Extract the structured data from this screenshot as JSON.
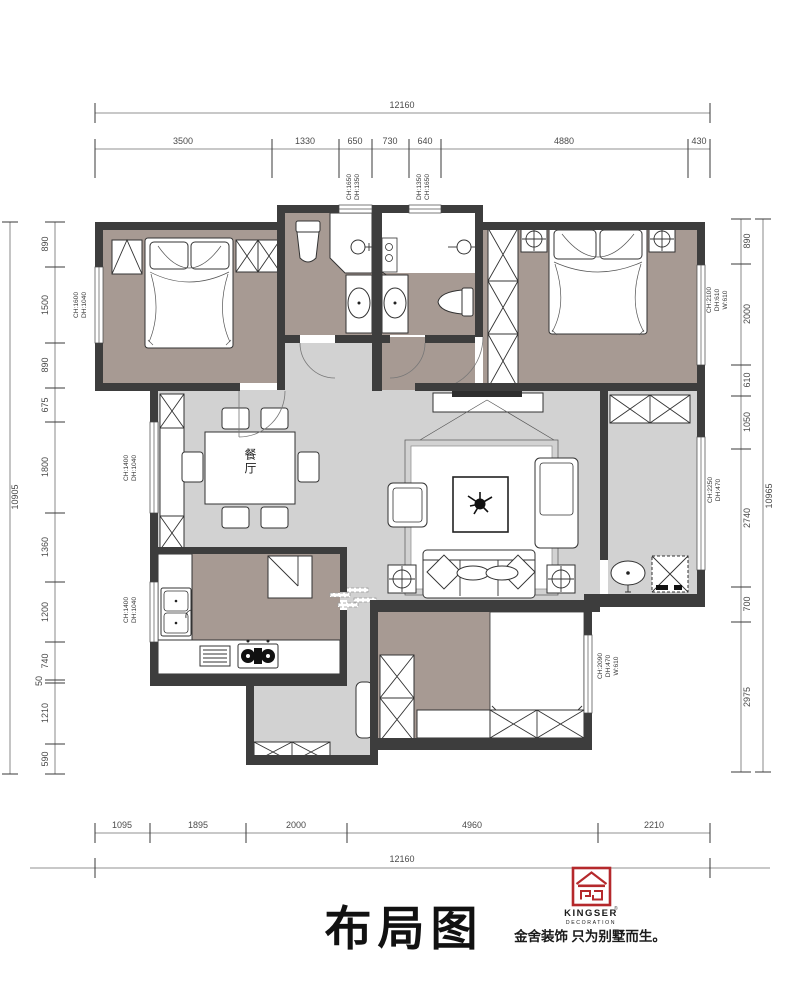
{
  "title": "布局图",
  "rooms": {
    "dining_label": "餐厅"
  },
  "logo": {
    "brand": "KINGSER",
    "registered": "®",
    "sub": "DECORATION",
    "tagline": "金舍装饰 只为别墅而生。",
    "accent_color": "#b5292c"
  },
  "dims": {
    "top": {
      "total": "12160",
      "segments": [
        "3500",
        "1330",
        "650",
        "730",
        "640",
        "4880",
        "430"
      ]
    },
    "bottom": {
      "total": "12160",
      "segments": [
        "1095",
        "1895",
        "2000",
        "4960",
        "2210"
      ]
    },
    "left": {
      "total": "10905",
      "segments": [
        "890",
        "1500",
        "890",
        "675",
        "1800",
        "1360",
        "1200",
        "740",
        "50",
        "1210",
        "590"
      ]
    },
    "right": {
      "total": "10965",
      "segments": [
        "890",
        "2000",
        "610",
        "1050",
        "2740",
        "700",
        "2975"
      ]
    }
  },
  "window_labels": {
    "top_a": {
      "l1": "CH:1650",
      "l2": "DH:1350"
    },
    "top_b": {
      "l1": "CH:1650",
      "l2": "DH:1350"
    },
    "left_a": {
      "l1": "CH:1600",
      "l2": "DH:1040"
    },
    "left_b": {
      "l1": "CH:1400",
      "l2": "DH:1040"
    },
    "left_c": {
      "l1": "CH:1400",
      "l2": "DH:1040"
    },
    "right_a": {
      "l1": "CH:2100",
      "l2": "DH:610",
      "l3": "W:610"
    },
    "right_b": {
      "l1": "CH:2250",
      "l2": "DH:470"
    },
    "right_c": {
      "l1": "CH:2090",
      "l2": "DH:470",
      "l3": "W:610"
    }
  },
  "colors": {
    "wall": "#3d3d3d",
    "bedroom_floor": "#a79a93",
    "living_floor": "#d2d2d2"
  }
}
